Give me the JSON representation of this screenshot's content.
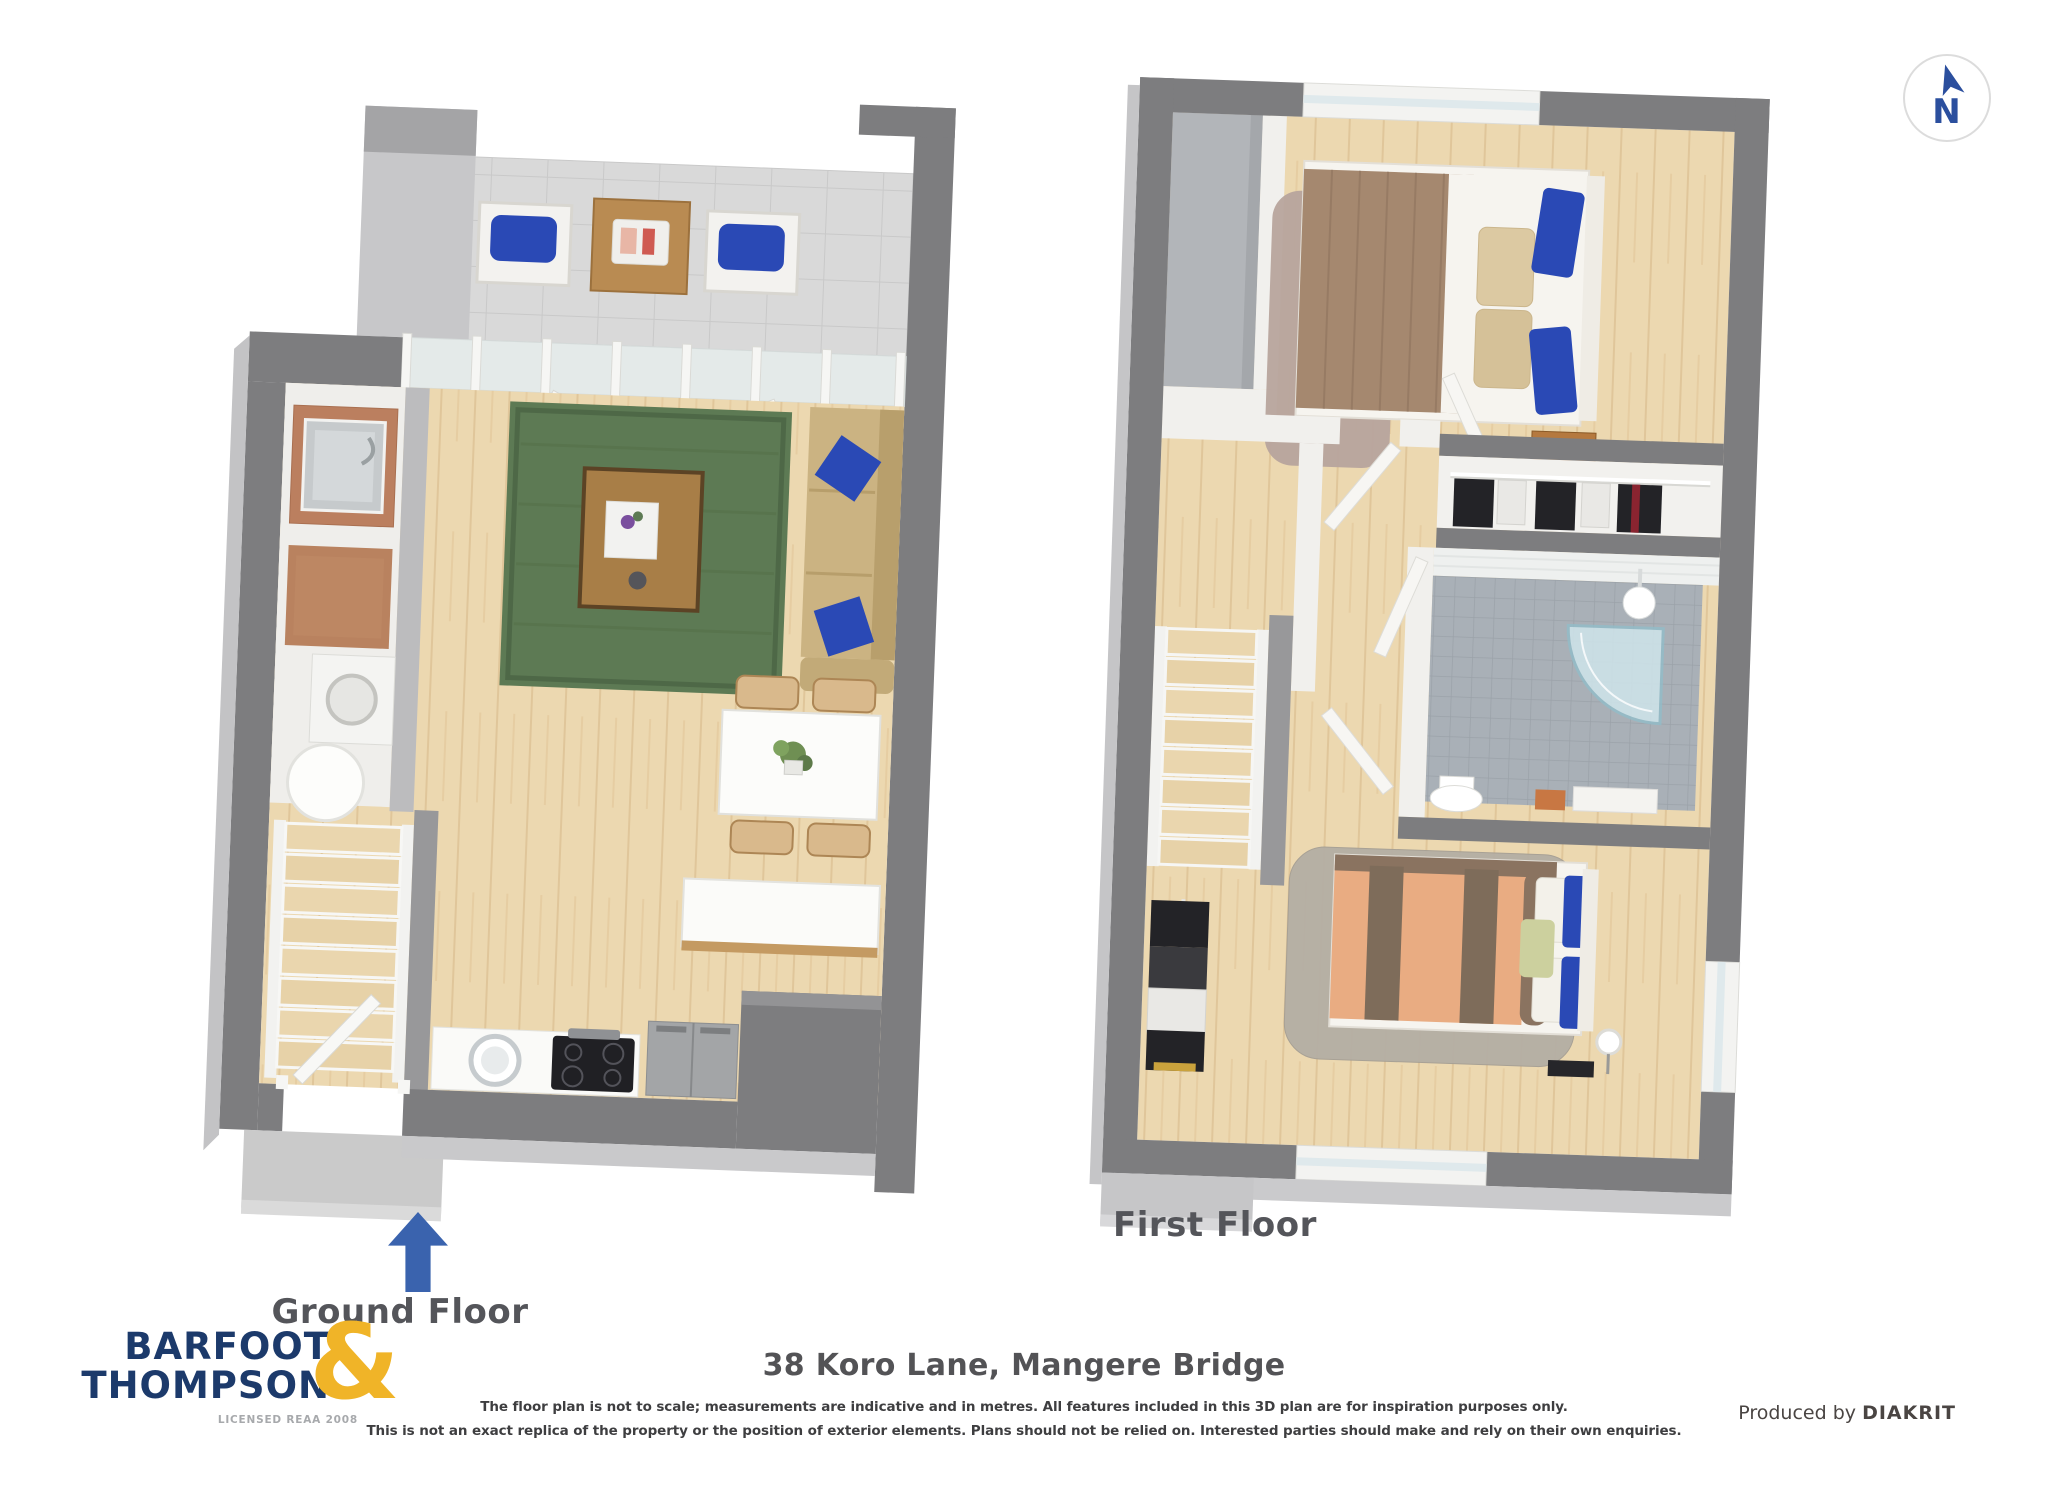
{
  "compass": {
    "north_label": "N"
  },
  "plans": {
    "ground": {
      "label": "Ground Floor"
    },
    "first": {
      "label": "First Floor"
    }
  },
  "footer": {
    "title": "38 Koro Lane, Mangere Bridge",
    "disclaimer_line1": "The floor plan is not to scale; measurements are indicative and in metres. All features included in this 3D plan are for inspiration purposes only.",
    "disclaimer_line2": "This is not an exact replica of the property or the position of exterior elements. Plans should not be relied on. Interested parties should make and rely on their own enquiries.",
    "produced_by_label": "Produced by ",
    "producer_name": "DIAKRIT"
  },
  "logo": {
    "word1": "BARFOOT",
    "word2": "THOMPSON",
    "ampersand": "&",
    "license": "LICENSED REAA 2008"
  },
  "colors": {
    "brand_navy": "#1c3a6b",
    "brand_yellow": "#f0b428",
    "compass_blue": "#2b4f9e",
    "entrance_arrow_blue": "#3a63ae",
    "label_gray": "#54555a",
    "wall_gray": "#7d7d7f",
    "wood_floor": "#ecd8b0",
    "patio_tile": "#d9d9d9",
    "rug_green": "#5d7a54",
    "rug_mauve": "#b7a49d",
    "rug_gray": "#b4aea4",
    "sofa_tan": "#cbb382",
    "pillow_blue": "#2a49b5",
    "duvet_brown": "#a5886f",
    "duvet_peach": "#e9ac82",
    "bathroom_tile": "#a9b0b7"
  }
}
